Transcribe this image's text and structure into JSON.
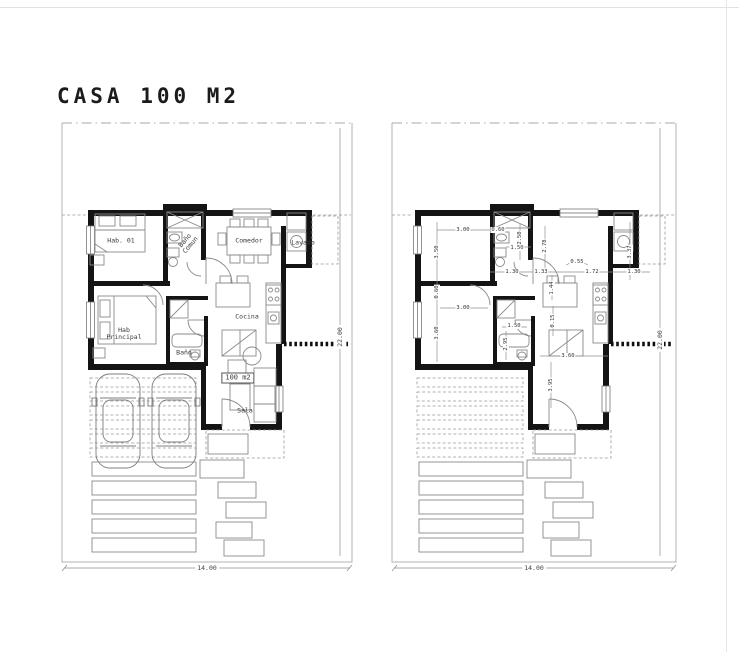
{
  "title": "CASA 100 M2",
  "left_plan": {
    "name": "furnished floor plan",
    "room_labels": [
      {
        "text": "Hab. 01",
        "x": 121,
        "y": 241
      },
      {
        "text": "Baño\nComun",
        "x": 188,
        "y": 243,
        "rot": -50
      },
      {
        "text": "Comedor",
        "x": 249,
        "y": 241
      },
      {
        "text": "Lavado",
        "x": 303,
        "y": 243
      },
      {
        "text": "Hab\nPrincipal",
        "x": 124,
        "y": 334
      },
      {
        "text": "Cocina",
        "x": 247,
        "y": 317
      },
      {
        "text": "Baño",
        "x": 184,
        "y": 353
      },
      {
        "text": "100 m2",
        "x": 238,
        "y": 378,
        "boxed": true
      },
      {
        "text": "Sala",
        "x": 245,
        "y": 411
      }
    ],
    "width_dim": "14.00",
    "height_dim": "22.00"
  },
  "right_plan": {
    "name": "dimensioned floor plan",
    "dim_labels": [
      {
        "text": "3.00",
        "x": 463,
        "y": 230
      },
      {
        "text": "0.60",
        "x": 498,
        "y": 230
      },
      {
        "text": "3.50",
        "x": 437,
        "y": 252,
        "rot": true
      },
      {
        "text": "2.50",
        "x": 520,
        "y": 238,
        "rot": true
      },
      {
        "text": "1.50",
        "x": 517,
        "y": 248
      },
      {
        "text": "2.78",
        "x": 545,
        "y": 246,
        "rot": true
      },
      {
        "text": "3.37",
        "x": 630,
        "y": 252,
        "rot": true
      },
      {
        "text": "0.55",
        "x": 577,
        "y": 262
      },
      {
        "text": "1.30",
        "x": 512,
        "y": 272
      },
      {
        "text": "1.33",
        "x": 541,
        "y": 272
      },
      {
        "text": "1.72",
        "x": 592,
        "y": 272
      },
      {
        "text": "1.30",
        "x": 634,
        "y": 272
      },
      {
        "text": "1.44",
        "x": 552,
        "y": 288,
        "rot": true
      },
      {
        "text": "0.60",
        "x": 437,
        "y": 292,
        "rot": true
      },
      {
        "text": "3.00",
        "x": 463,
        "y": 308
      },
      {
        "text": "3.60",
        "x": 437,
        "y": 333,
        "rot": true
      },
      {
        "text": "1.50",
        "x": 514,
        "y": 326
      },
      {
        "text": "2.95",
        "x": 506,
        "y": 344,
        "rot": true
      },
      {
        "text": "0.15",
        "x": 553,
        "y": 321,
        "rot": true
      },
      {
        "text": "3.60",
        "x": 568,
        "y": 356
      },
      {
        "text": "3.95",
        "x": 551,
        "y": 385,
        "rot": true
      }
    ],
    "width_dim": "14.00",
    "height_dim": "22.00"
  }
}
